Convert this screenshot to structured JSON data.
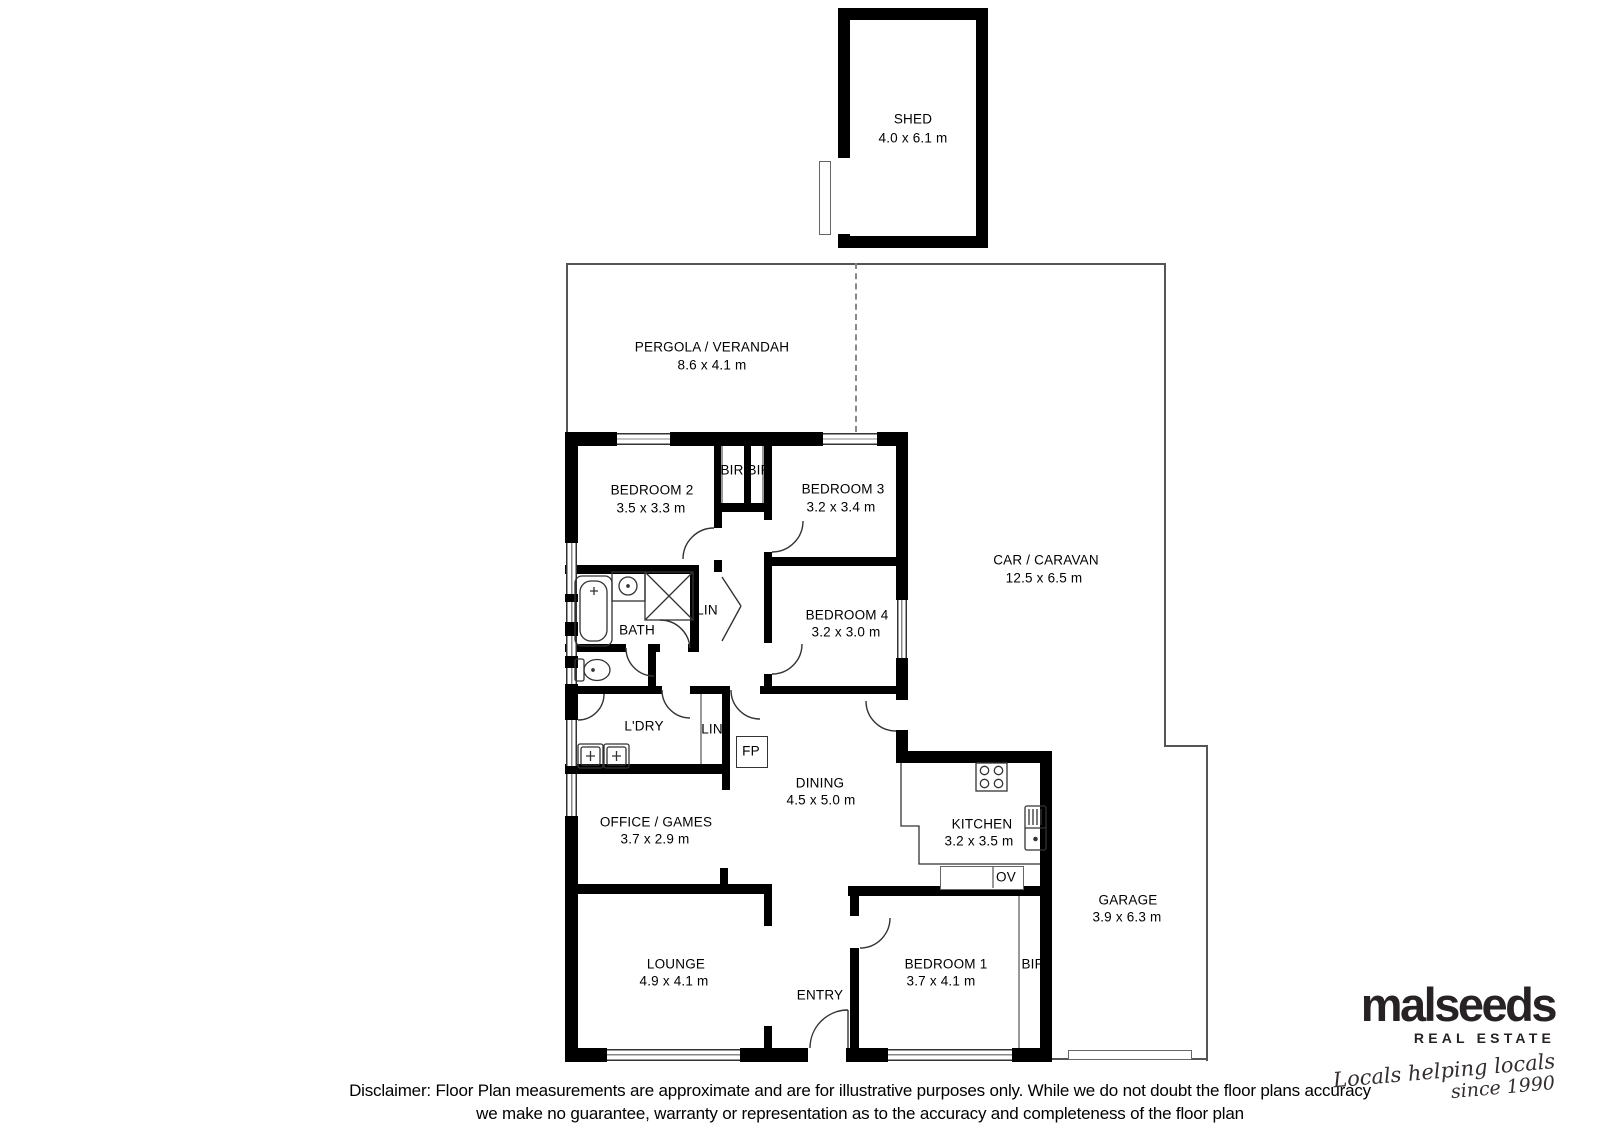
{
  "plan": {
    "shed": {
      "name": "SHED",
      "dims": "4.0 x 6.1 m"
    },
    "pergola": {
      "name": "PERGOLA / VERANDAH",
      "dims": "8.6 x 4.1 m"
    },
    "car_caravan": {
      "name": "CAR / CARAVAN",
      "dims": "12.5 x 6.5 m"
    },
    "bedroom2": {
      "name": "BEDROOM 2",
      "dims": "3.5 x 3.3 m"
    },
    "bedroom3": {
      "name": "BEDROOM 3",
      "dims": "3.2 x 3.4 m"
    },
    "bedroom4": {
      "name": "BEDROOM 4",
      "dims": "3.2 x 3.0 m"
    },
    "bedroom1": {
      "name": "BEDROOM 1",
      "dims": "3.7 x 4.1 m"
    },
    "bath": {
      "name": "BATH"
    },
    "laundry": {
      "name": "L'DRY"
    },
    "lin_hall": {
      "name": "LIN"
    },
    "lin_laundry": {
      "name": "LIN"
    },
    "fireplace": {
      "name": "FP"
    },
    "dining": {
      "name": "DINING",
      "dims": "4.5 x 5.0 m"
    },
    "office": {
      "name": "OFFICE / GAMES",
      "dims": "3.7 x 2.9 m"
    },
    "kitchen": {
      "name": "KITCHEN",
      "dims": "3.2 x 3.5 m"
    },
    "oven": {
      "name": "OV"
    },
    "lounge": {
      "name": "LOUNGE",
      "dims": "4.9 x 4.1 m"
    },
    "entry": {
      "name": "ENTRY"
    },
    "bir_hall_left": {
      "name": "BIR"
    },
    "bir_hall_right": {
      "name": "BIR"
    },
    "bir_bedroom1": {
      "name": "BIR"
    },
    "garage": {
      "name": "GARAGE",
      "dims": "3.9 x 6.3 m"
    }
  },
  "branding": {
    "name": "malseeds",
    "division": "REAL ESTATE",
    "tagline_line1": "Locals helping locals",
    "tagline_line2": "since 1990"
  },
  "disclaimer": {
    "line1": "Disclaimer: Floor Plan measurements are approximate and are for illustrative purposes only. While we do not doubt the floor plans accuracy",
    "line2": "we make no guarantee, warranty or representation as to the accuracy and completeness of the floor plan"
  }
}
